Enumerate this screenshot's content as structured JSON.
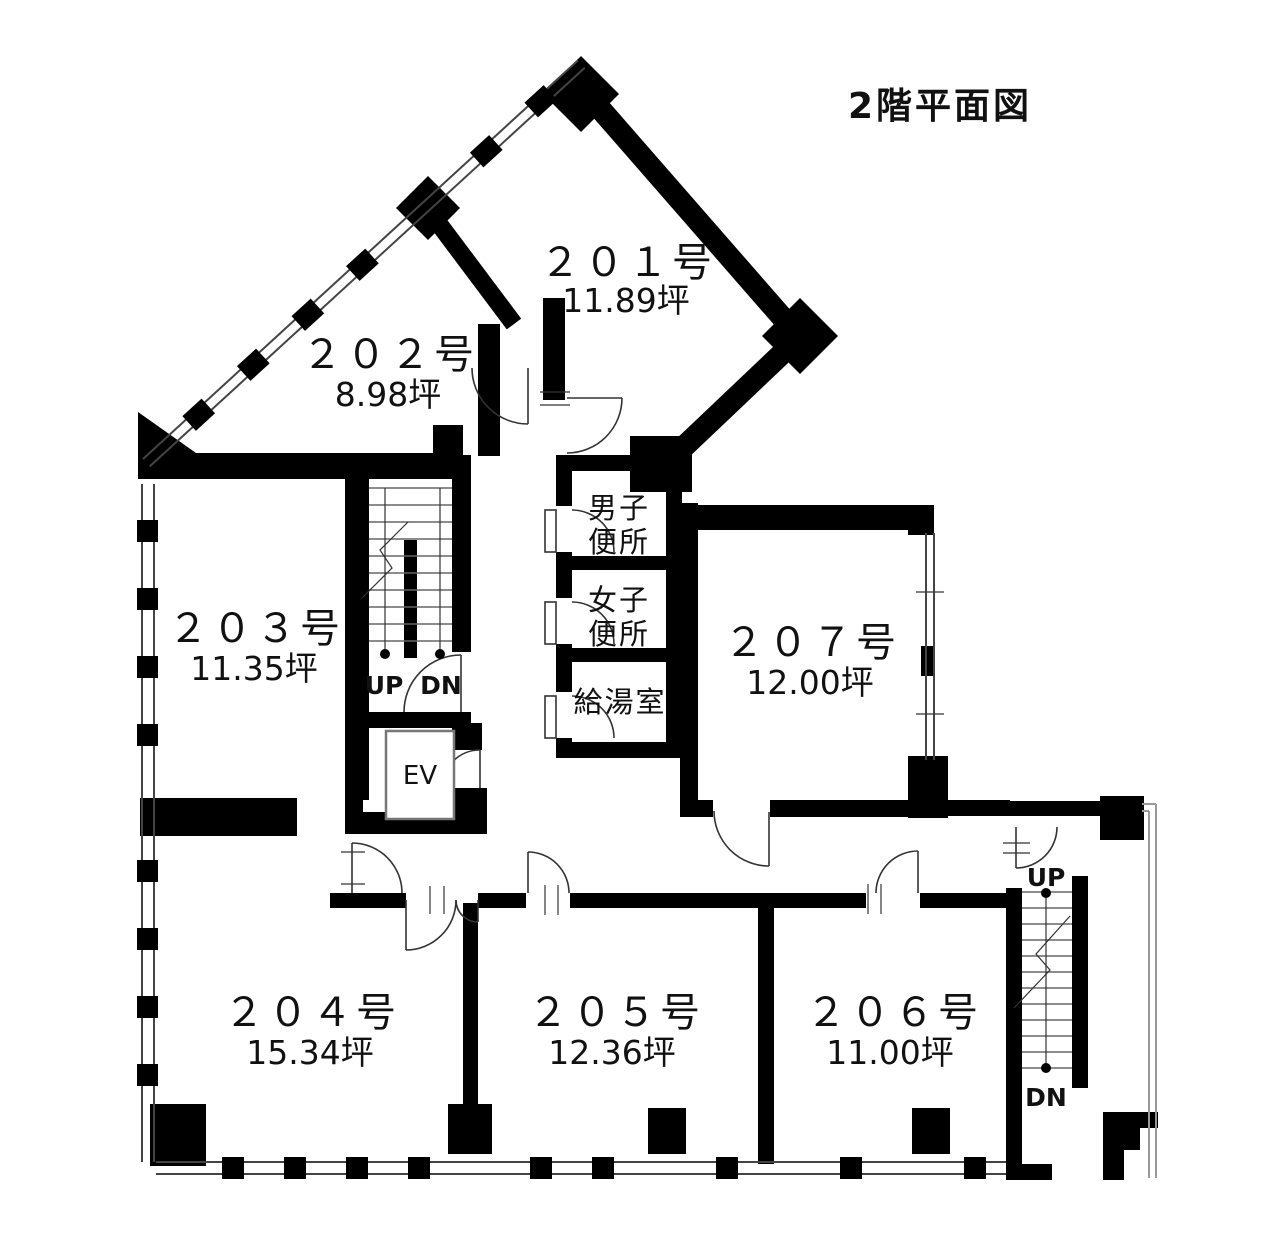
{
  "title": "2階平面図",
  "colors": {
    "wall": "#000000",
    "area_value": "#cc4b4b"
  },
  "rooms": [
    {
      "id": "201",
      "name": "２０１号",
      "area": "11.89坪"
    },
    {
      "id": "202",
      "name": "２０２号",
      "area": "8.98坪"
    },
    {
      "id": "203",
      "name": "２０３号",
      "area": "11.35坪"
    },
    {
      "id": "204",
      "name": "２０４号",
      "area": "15.34坪"
    },
    {
      "id": "205",
      "name": "２０５号",
      "area": "12.36坪"
    },
    {
      "id": "206",
      "name": "２０６号",
      "area": "11.00坪"
    },
    {
      "id": "207",
      "name": "２０７号",
      "area": "12.00坪"
    }
  ],
  "facilities": {
    "mens_toilet_line1": "男子",
    "mens_toilet_line2": "便所",
    "womens_toilet_line1": "女子",
    "womens_toilet_line2": "便所",
    "kitchenette": "給湯室",
    "elevator": "EV"
  },
  "stairs": {
    "center_up": "UP",
    "center_dn": "DN",
    "right_up": "UP",
    "right_dn": "DN"
  }
}
